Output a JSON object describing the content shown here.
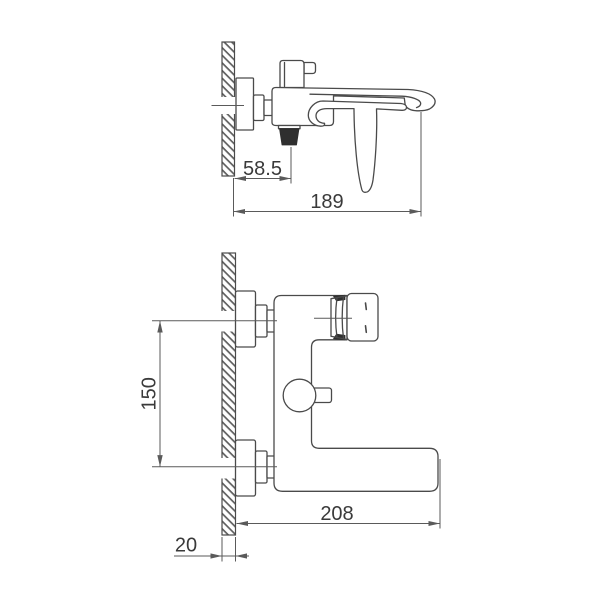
{
  "drawing": {
    "colors": {
      "background": "#ffffff",
      "line": "#4a4a4a",
      "dimension_line": "#5a5a5a",
      "text": "#3a3a3a",
      "dark_fill": "#2f2f2f"
    },
    "side_view": {
      "dim_outlet_offset": "58.5",
      "dim_spout_reach": "189"
    },
    "front_view": {
      "dim_port_center_distance": "150",
      "dim_body_reach": "208",
      "dim_wall_thickness": "20"
    }
  }
}
